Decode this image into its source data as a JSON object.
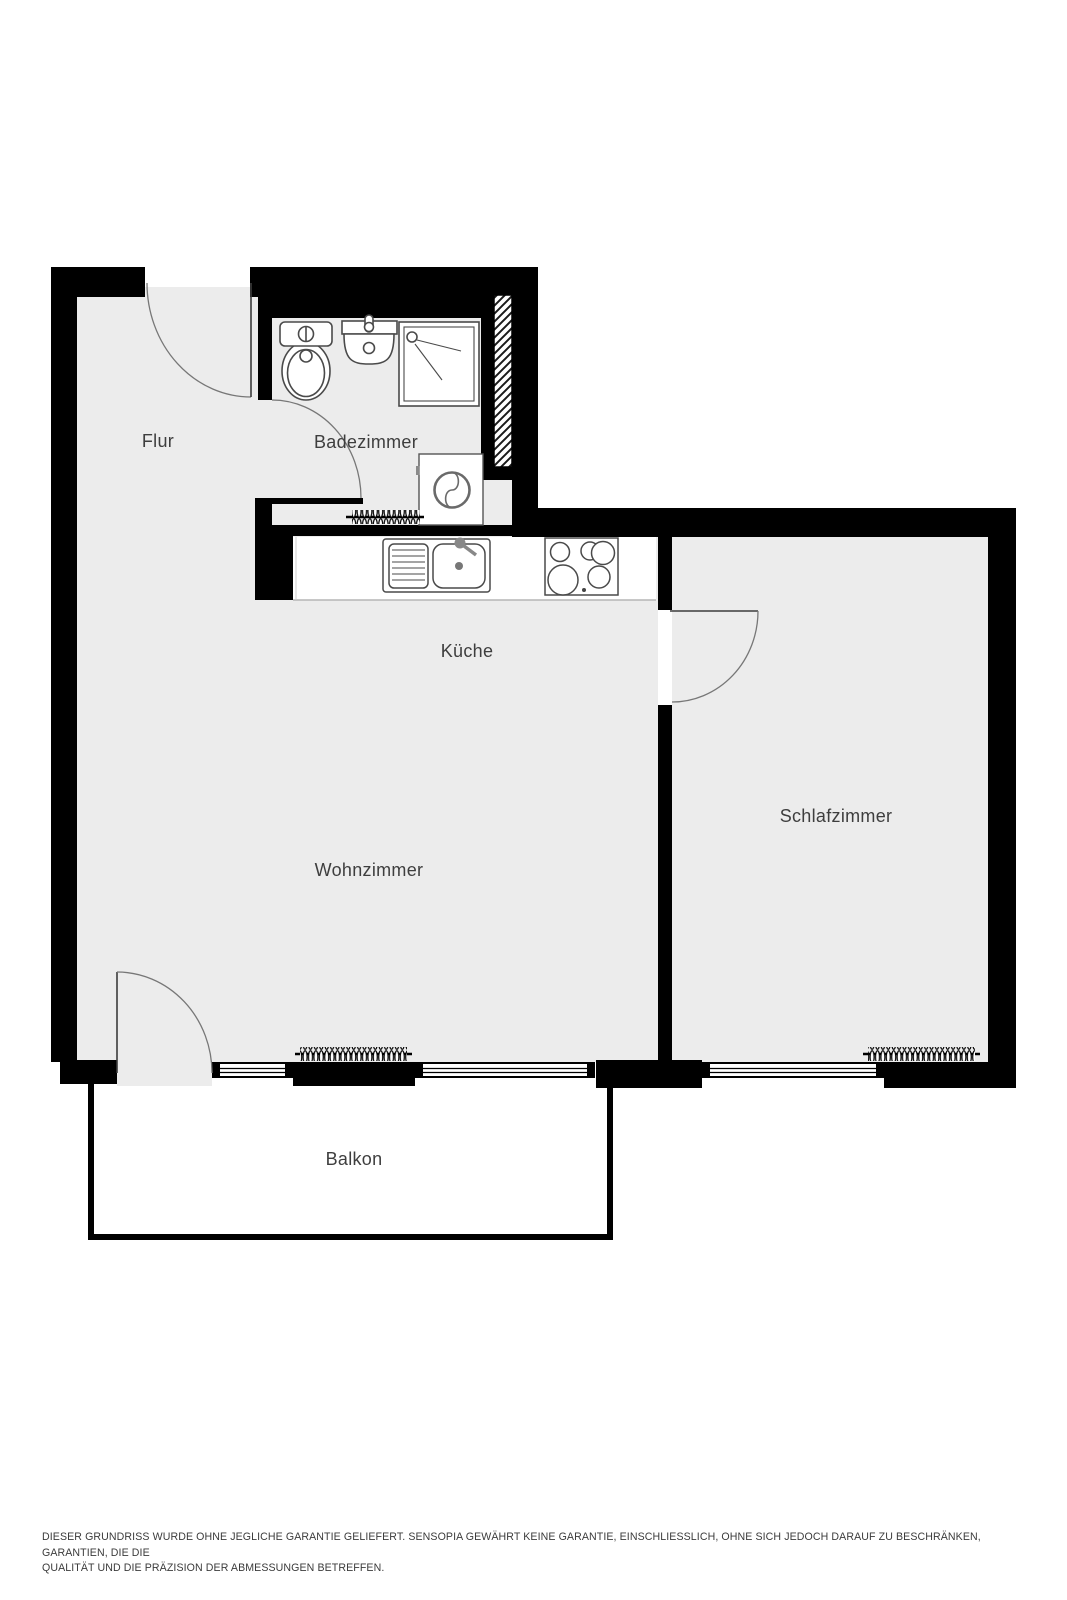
{
  "floorplan": {
    "rooms": [
      {
        "id": "flur",
        "label": "Flur"
      },
      {
        "id": "badezimmer",
        "label": "Badezimmer"
      },
      {
        "id": "kueche",
        "label": "Küche"
      },
      {
        "id": "wohnzimmer",
        "label": "Wohnzimmer"
      },
      {
        "id": "schlafzimmer",
        "label": "Schlafzimmer"
      },
      {
        "id": "balkon",
        "label": "Balkon"
      }
    ],
    "fixtures": [
      "toilet-icon",
      "bathroom-sink-icon",
      "shower-icon",
      "washing-machine-icon",
      "radiator-icon",
      "kitchen-sink-icon",
      "stove-icon",
      "shaft-hatch"
    ],
    "colors": {
      "wall": "#000000",
      "floor": "#ececec",
      "fixture_outline": "#4a4a4a",
      "door_arc": "#777777",
      "label": "#3e3e3e",
      "disclaimer": "#3b3b3b"
    },
    "disclaimer": {
      "line1": "DIESER GRUNDRISS WURDE OHNE JEGLICHE GARANTIE GELIEFERT. SENSOPIA GEWÄHRT KEINE GARANTIE, EINSCHLIESSLICH, OHNE SICH JEDOCH DARAUF ZU BESCHRÄNKEN, GARANTIEN, DIE DIE",
      "line2": "QUALITÄT UND DIE PRÄZISION DER ABMESSUNGEN BETREFFEN."
    }
  }
}
